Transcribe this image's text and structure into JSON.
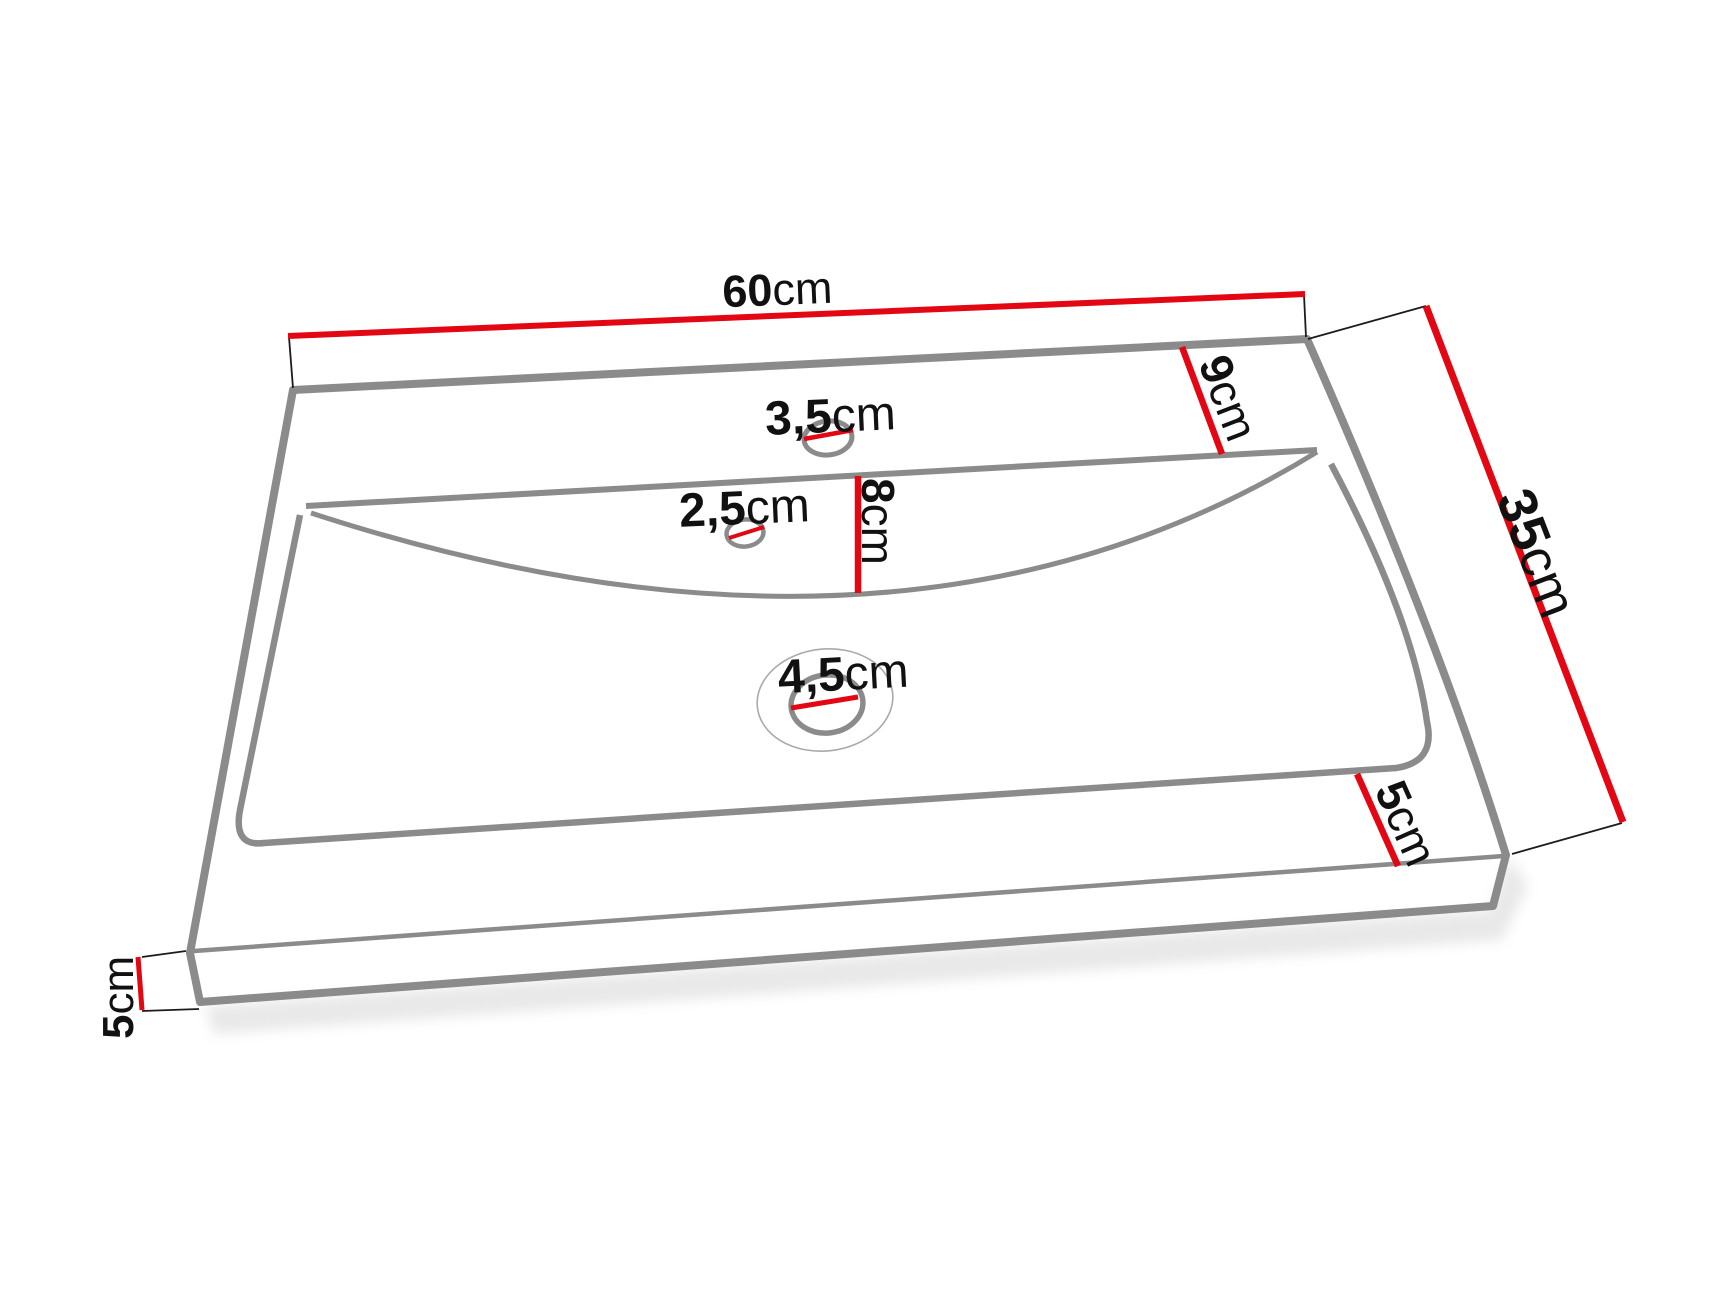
{
  "diagram": {
    "kind": "washbasin-dimension-drawing",
    "background": "#ffffff"
  },
  "colors": {
    "dimension": "#e30613",
    "outline": "#8b8b8b",
    "outline_light": "#aaaaaa",
    "extension": "#1c1c1c",
    "text": "#111111",
    "shadow": "#9a9a9a"
  },
  "labels": {
    "width": {
      "num": "60",
      "unit": "cm"
    },
    "depth": {
      "num": "35",
      "unit": "cm"
    },
    "back_ledge": {
      "num": "9",
      "unit": "cm"
    },
    "basin_depth": {
      "num": "8",
      "unit": "cm"
    },
    "front_ledge": {
      "num": "5",
      "unit": "cm"
    },
    "thickness": {
      "num": "5",
      "unit": "cm"
    },
    "hole_faucet": {
      "num": "3,5",
      "unit": "cm"
    },
    "hole_overflow": {
      "num": "2,5",
      "unit": "cm"
    },
    "hole_drain": {
      "num": "4,5",
      "unit": "cm"
    }
  }
}
